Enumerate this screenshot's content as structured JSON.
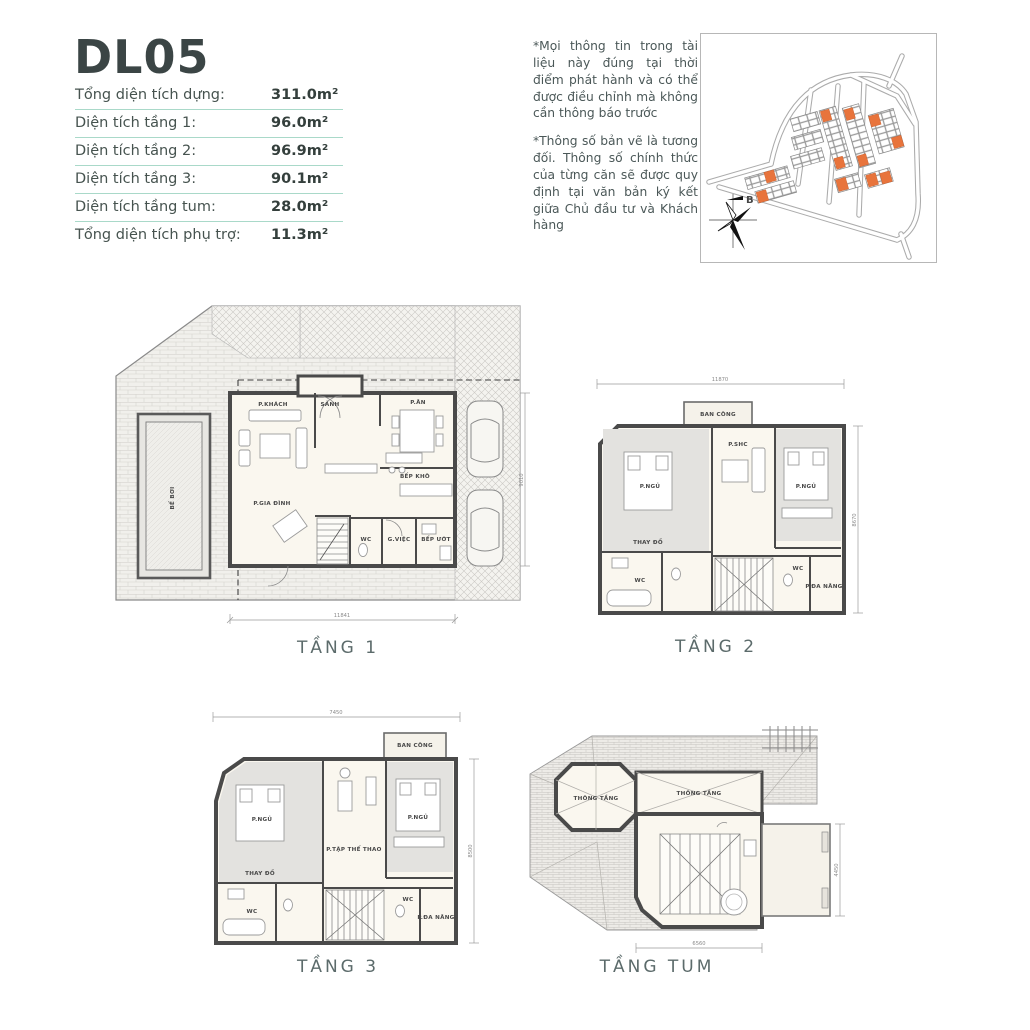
{
  "header": {
    "unit_code": "DL05"
  },
  "area_table": {
    "rows": [
      {
        "label": "Tổng diện tích dựng:",
        "value": "311.0m²"
      },
      {
        "label": "Diện tích tầng 1:",
        "value": "96.0m²"
      },
      {
        "label": "Diện tích tầng 2:",
        "value": "96.9m²"
      },
      {
        "label": "Diện tích tầng 3:",
        "value": "90.1m²"
      },
      {
        "label": "Diện tích tầng tum:",
        "value": "28.0m²"
      },
      {
        "label": "Tổng diện tích phụ trợ:",
        "value": "11.3m²"
      }
    ]
  },
  "disclaimer": {
    "para1": "*Mọi thông tin trong tài liệu này đúng tại thời điểm phát hành và có thể được điều chỉnh mà không cần thông báo trước",
    "para2": "*Thông số bản vẽ là tương đối. Thông số chính thức của từng căn sẽ được quy định tại văn bản ký kết giữa Chủ đầu tư và Khách hàng"
  },
  "site_map": {
    "compass_label": "B",
    "highlight_color": "#E8743C"
  },
  "plans": {
    "tang1": {
      "caption": "TẦNG 1",
      "rooms": {
        "sanh": "SẢNH",
        "khach": "P.KHÁCH",
        "an": "P.ĂN",
        "gia_dinh": "P.GIA ĐÌNH",
        "bep_kho": "BẾP KHÔ",
        "wc": "WC",
        "g_viec": "G.VIỆC",
        "bep_uot": "BẾP ƯỚT",
        "be_boi": "BỂ BƠI"
      },
      "dims": {
        "bottom": "11841",
        "right": "9010"
      }
    },
    "tang2": {
      "caption": "TẦNG 2",
      "rooms": {
        "ban_cong": "BAN CÔNG",
        "ngu_trai": "P.NGỦ",
        "shc": "P.SHC",
        "ngu_phai": "P.NGỦ",
        "thay_do": "THAY ĐỒ",
        "wc_trai": "WC",
        "wc_phai": "WC",
        "da_nang": "P.ĐA NĂNG"
      },
      "dims": {
        "top": "11870",
        "right": "8670"
      }
    },
    "tang3": {
      "caption": "TẦNG 3",
      "rooms": {
        "ban_cong": "BAN CÔNG",
        "ngu_trai": "P.NGỦ",
        "the_thao": "P.TẬP THỂ THAO",
        "ngu_phai": "P.NGỦ",
        "thay_do": "THAY ĐỒ",
        "wc_trai": "WC",
        "wc_phai": "WC",
        "da_nang": "P.ĐA NĂNG"
      },
      "dims": {
        "top": "7450",
        "right": "8500"
      }
    },
    "tum": {
      "caption": "TẦNG TUM",
      "rooms": {
        "thong_tang_1": "THÔNG TẦNG",
        "thong_tang_2": "THÔNG TẦNG"
      },
      "dims": {
        "bottom": "6560",
        "right": "4450"
      }
    }
  }
}
